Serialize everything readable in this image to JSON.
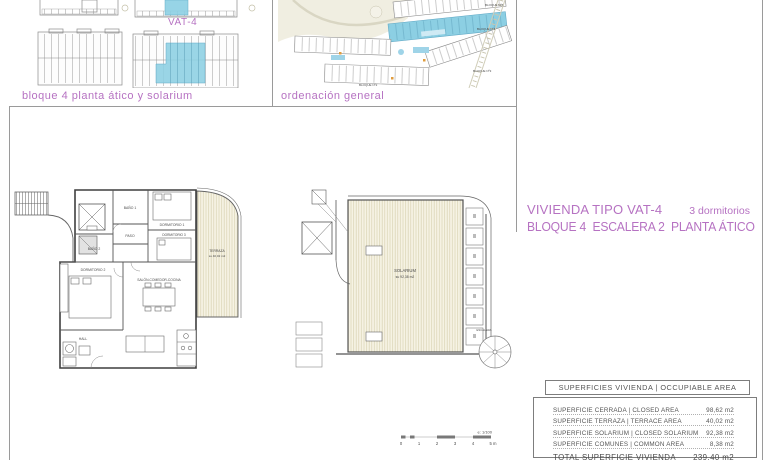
{
  "colors": {
    "accent_magenta": "#b672c2",
    "highlight_blue": "#8ccfe3",
    "deck_cream": "#f6f3e4",
    "drawing_line": "#555555"
  },
  "top_left_panel": {
    "caption": "bloque 4 planta ático y solarium",
    "unit_tag": "VAT-4"
  },
  "site_panel": {
    "caption": "ordenación general",
    "block_labels": [
      "BLOQUE Nº5",
      "BLOQUE Nº4",
      "BLOQUE Nº3",
      "BLOQUE Nº2"
    ]
  },
  "title_block": {
    "line1": "VIVIENDA TIPO VAT-4",
    "bedrooms": "3 dormitorios",
    "line2": "BLOQUE 4  ESCALERA 2  PLANTA ÁTICO"
  },
  "floor_plan": {
    "rooms": {
      "bano1": "BAÑO 1",
      "paso": "PASO",
      "bano2": "BAÑO 2",
      "dorm1": "DORMITORIO 1",
      "dorm3": "DORMITORIO 3",
      "dorm2": "DORMITORIO 2",
      "salon": "SALÓN-COMEDOR-COCINA",
      "hall": "HALL",
      "terraza": "TERRAZA",
      "terraza_area": "su 40,02 m2"
    }
  },
  "solarium_plan": {
    "label": "SOLARIUM",
    "area": "su 92,38 m2",
    "stair": "ESCALERA"
  },
  "scale_bar": {
    "note": "e: 1/100",
    "ticks": [
      "0",
      "1",
      "2",
      "3",
      "4",
      "5 m"
    ]
  },
  "areas_table": {
    "header": "SUPERFICIES VIVIENDA | OCCUPIABLE AREA",
    "rows": [
      {
        "label": "SUPERFICIE CERRADA | CLOSED AREA",
        "value": "98,62 m2"
      },
      {
        "label": "SUPERFICIE TERRAZA | TERRACE AREA",
        "value": "40,02 m2"
      },
      {
        "label": "SUPERFICIE SOLARIUM | CLOSED SOLARIUM",
        "value": "92,38 m2"
      },
      {
        "label": "SUPERFICIE COMUNES | COMMON AREA",
        "value": "8,38 m2"
      }
    ],
    "total": {
      "label": "TOTAL SUPERFICIE VIVIENDA",
      "value": "239,40 m2"
    }
  }
}
